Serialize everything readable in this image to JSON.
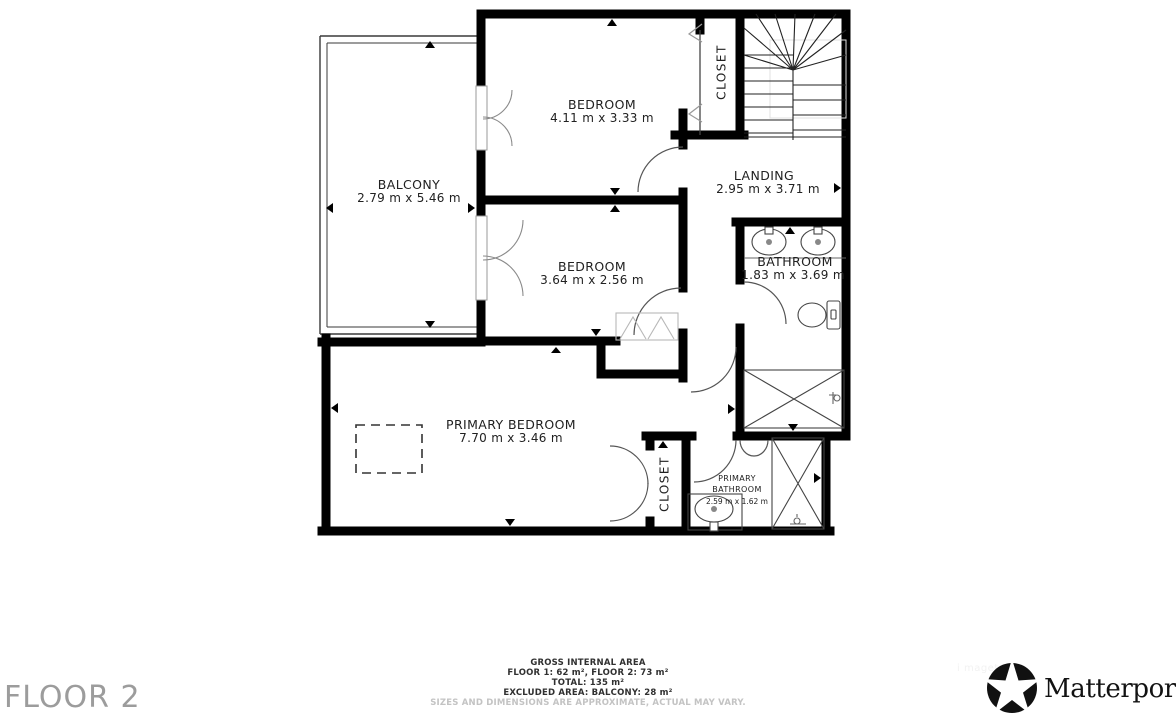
{
  "floor_plan": {
    "rooms": {
      "balcony": {
        "name": "BALCONY",
        "dims": "2.79 m x 5.46 m"
      },
      "bedroom_top": {
        "name": "BEDROOM",
        "dims": "4.11 m x 3.33 m"
      },
      "bedroom_middle": {
        "name": "BEDROOM",
        "dims": "3.64 m x 2.56 m"
      },
      "landing": {
        "name": "LANDING",
        "dims": "2.95 m x 3.71 m"
      },
      "bathroom": {
        "name": "BATHROOM",
        "dims": "1.83 m x 3.69 m"
      },
      "primary_bedroom": {
        "name": "PRIMARY BEDROOM",
        "dims": "7.70 m x 3.46 m"
      },
      "closet_top": {
        "name": "CLOSET"
      },
      "closet_bottom": {
        "name": "CLOSET"
      },
      "primary_bathroom": {
        "name_line1": "PRIMARY",
        "name_line2": "BATHROOM",
        "dims": "2.59 m x 1.62 m"
      }
    },
    "footer": {
      "title": "GROSS INTERNAL AREA",
      "floors": "FLOOR 1: 62 m², FLOOR 2: 73 m²",
      "total": "TOTAL: 135 m²",
      "excluded": "EXCLUDED AREA: BALCONY: 28 m²",
      "disclaimer": "SIZES AND DIMENSIONS ARE APPROXIMATE, ACTUAL MAY VARY."
    },
    "floor_label": "FLOOR 2",
    "brand": {
      "wordmark": "Matterport",
      "registered": "®"
    },
    "watermark": "i magetag",
    "icons": {
      "fixtures": [
        "sink-icon",
        "toilet-icon",
        "shower-icon",
        "stairs-icon"
      ],
      "brand_icon": "matterport-pinwheel-icon"
    },
    "colors": {
      "wall": "#000000",
      "label": "#212121",
      "floor_label": "#9c9c9c",
      "disclaimer": "#c3c3c3"
    }
  }
}
